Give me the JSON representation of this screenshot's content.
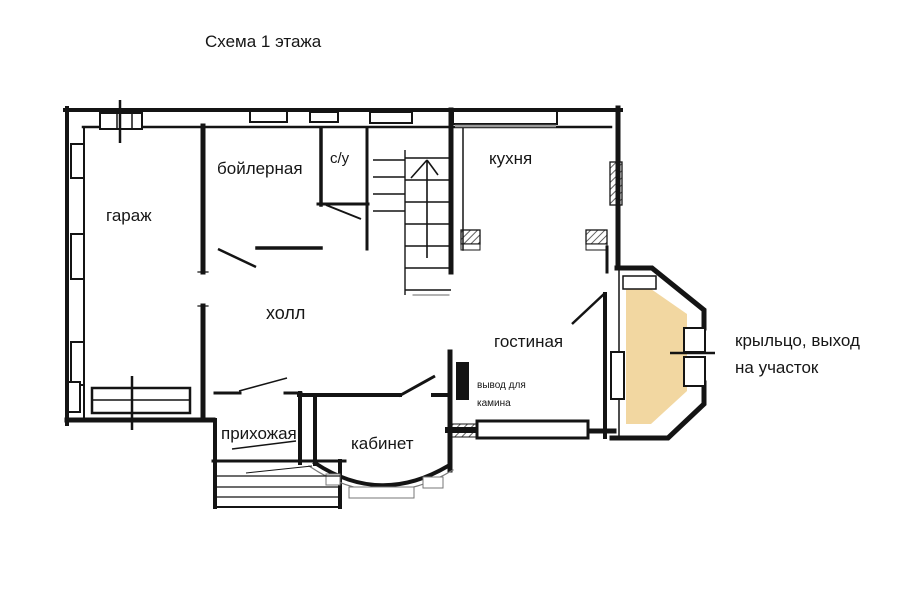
{
  "title": "Схема 1 этажа",
  "rooms": {
    "garage": "гараж",
    "boiler": "бойлерная",
    "bathroom": "с/у",
    "kitchen": "кухня",
    "hall": "холл",
    "living": "гостиная",
    "entry": "прихожая",
    "office": "кабинет"
  },
  "annotations": {
    "fireplace_line1": "вывод для",
    "fireplace_line2": "камина",
    "porch_line1": "крыльцо, выход",
    "porch_line2": "на участок"
  },
  "colors": {
    "walls": "#141414",
    "porch_fill": "#f2d7a1",
    "background": "#ffffff"
  }
}
